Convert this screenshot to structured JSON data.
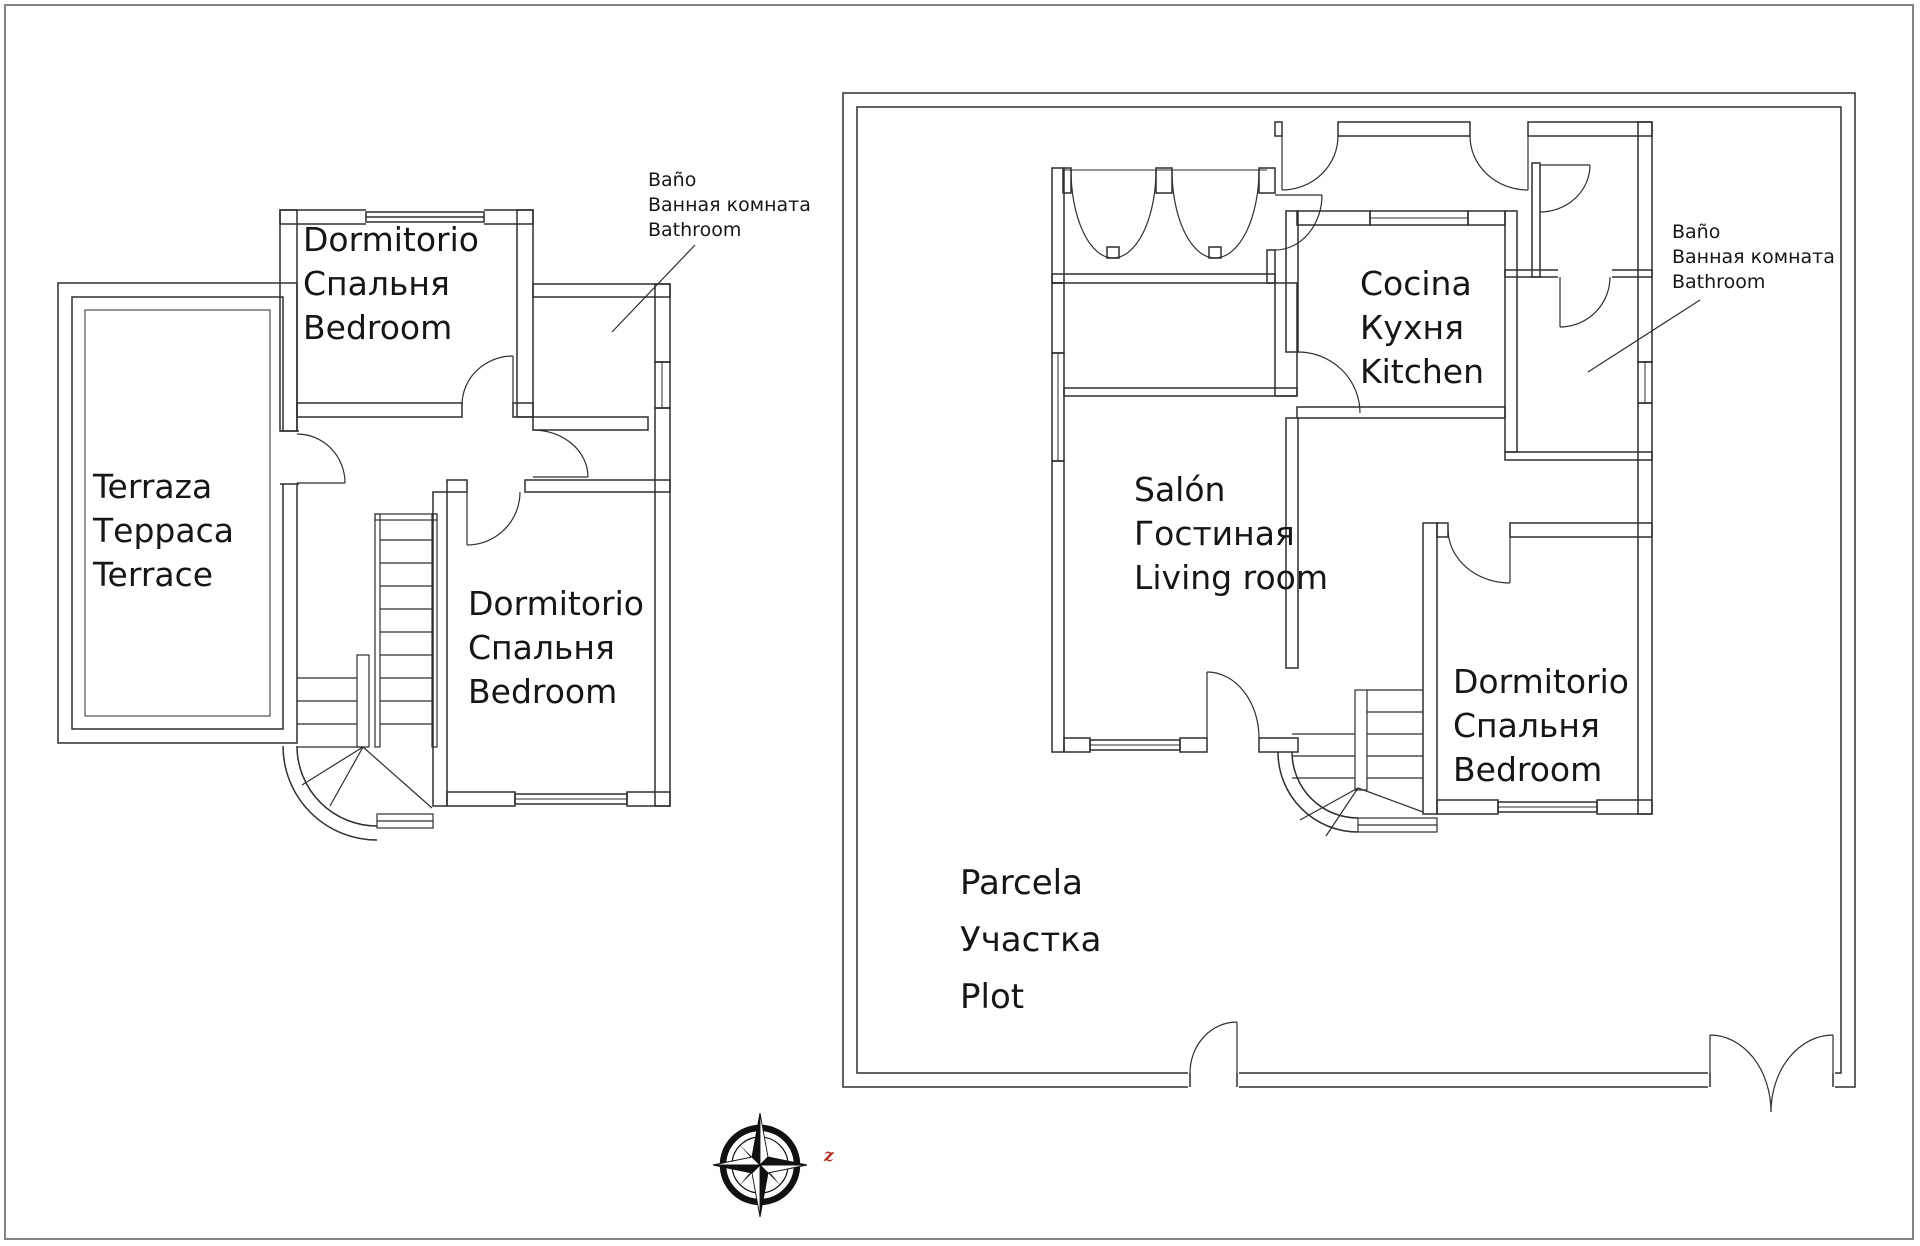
{
  "colors": {
    "line": "#2f2f2f",
    "frame": "#848484",
    "text": "#161616",
    "compass_letter_color": "#b23226"
  },
  "labels": {
    "plan1_bedroom1": [
      "Dormitorio",
      "Спальня",
      "Bedroom"
    ],
    "plan1_terrace": [
      "Terraza",
      "Терраса",
      "Terrace"
    ],
    "plan1_bedroom2": [
      "Dormitorio",
      "Спальня",
      "Bedroom"
    ],
    "plan1_bath_note": [
      "Baño",
      "Ванная комната",
      "Bathroom"
    ],
    "plan2_kitchen": [
      "Cocina",
      "Кухня",
      "Kitchen"
    ],
    "plan2_living": [
      "Salón",
      "Гостиная",
      "Living room"
    ],
    "plan2_bedroom": [
      "Dormitorio",
      "Спальня",
      "Bedroom"
    ],
    "plan2_plot": [
      "Parcela",
      "Участка",
      "Plot"
    ],
    "plan2_bath_note": [
      "Baño",
      "Ванная комната",
      "Bathroom"
    ],
    "compass_letter": "z"
  }
}
